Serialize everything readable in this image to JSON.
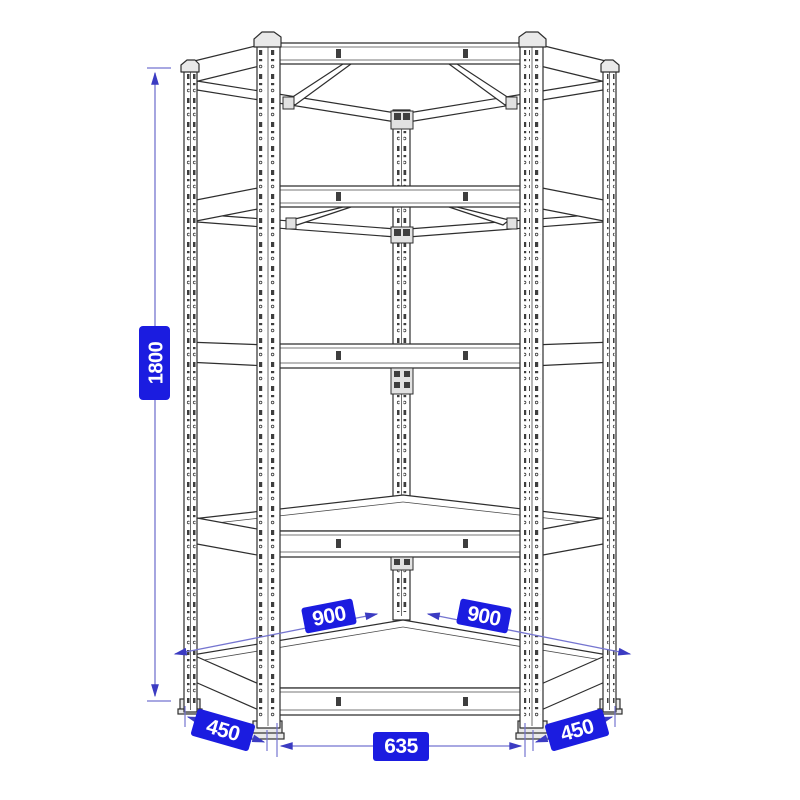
{
  "diagram": {
    "shelf_count": 5,
    "dimensions": {
      "height": "1800",
      "left_back_width": "900",
      "right_back_width": "900",
      "front_width": "635",
      "left_depth": "450",
      "right_depth": "450"
    },
    "colors": {
      "badge_background": "#1b1ce0",
      "badge_text": "#ffffff",
      "dimension_line": "#7575d0",
      "arrow": "#3b3bc2",
      "outline": "#2e2e2e"
    }
  }
}
